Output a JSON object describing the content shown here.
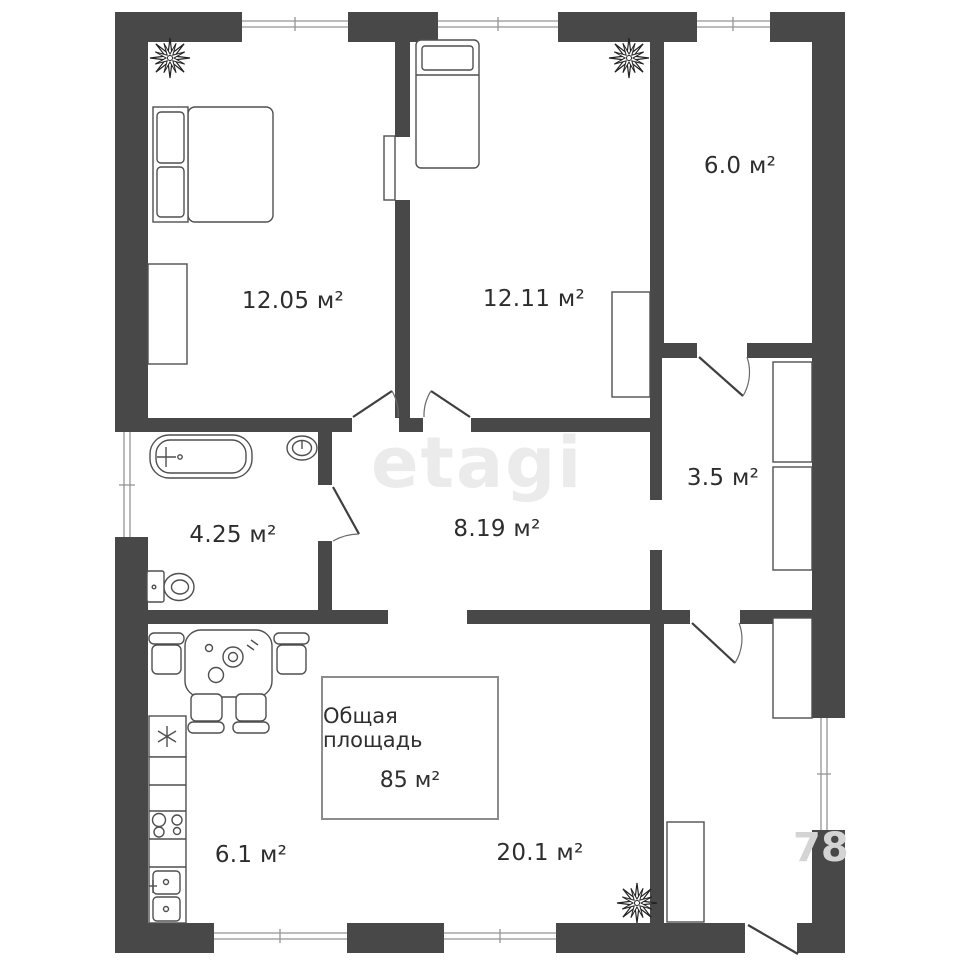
{
  "plan": {
    "brand_watermark": "etagi",
    "corner_watermark": "78",
    "total_box": {
      "title": "Общая площадь",
      "value": "85 м²"
    },
    "rooms": {
      "bedroom1": {
        "label": "12.05 м²"
      },
      "bedroom2": {
        "label": "12.11 м²"
      },
      "storage": {
        "label": "6.0 м²"
      },
      "closet": {
        "label": "3.5 м²"
      },
      "bathroom": {
        "label": "4.25 м²"
      },
      "corridor": {
        "label": "8.19 м²"
      },
      "kitchen": {
        "label": "6.1 м²"
      },
      "living": {
        "label": "20.1 м²"
      }
    }
  }
}
